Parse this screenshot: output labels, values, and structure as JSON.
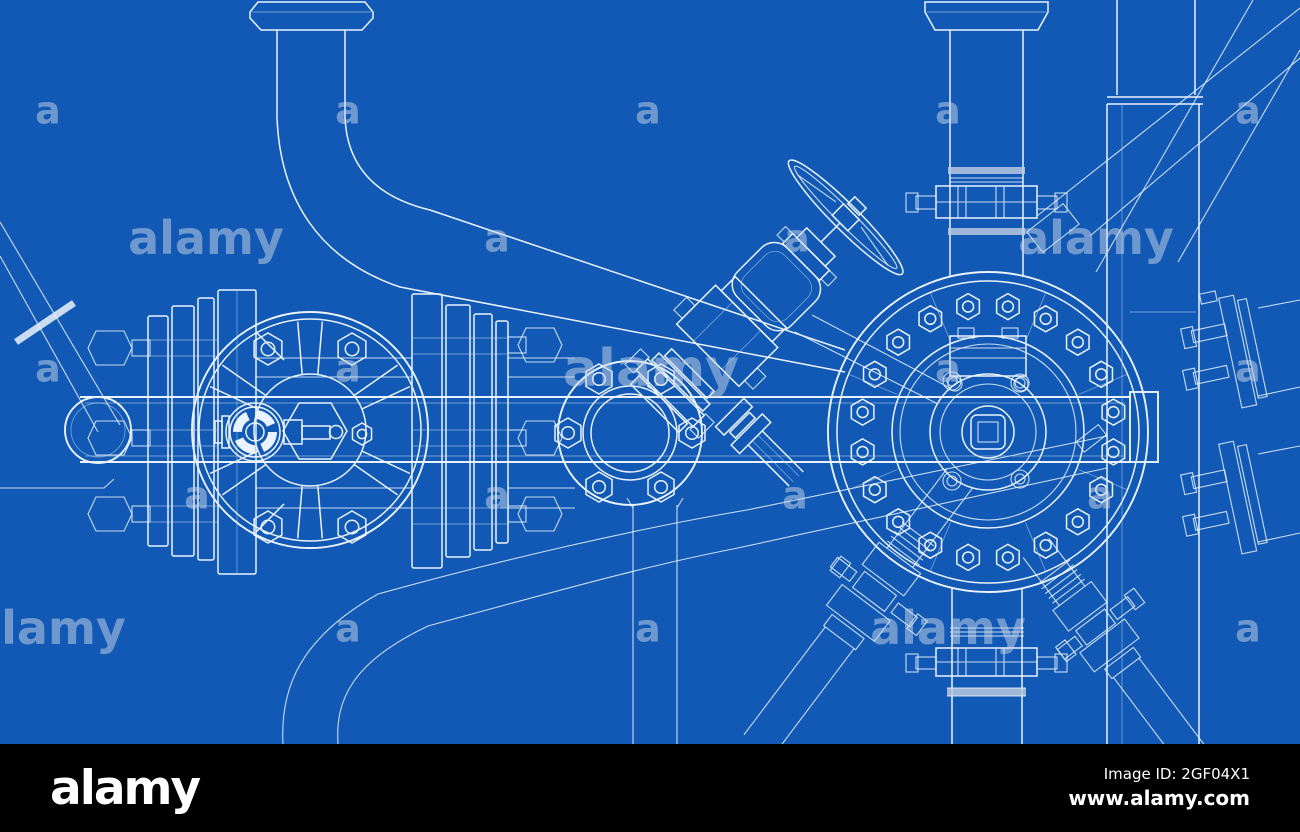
{
  "image": {
    "kind": "blueprint wireframe drawing",
    "subject": "industrial pipes, flanges and valves sketch on blue background",
    "width": 1300,
    "height": 832
  },
  "colors": {
    "background": "#1159b4",
    "line": "#eaf3fd",
    "faint_line": "#bcd6f0",
    "watermark": "#c6d4e6",
    "footer_bar": "#000000",
    "footer_text": "#ffffff",
    "band_fill": "#b9c9df"
  },
  "watermark": {
    "opacity": 0.52,
    "tile_items": [
      {
        "text": "a",
        "x": 48,
        "y": 110
      },
      {
        "text": "a",
        "x": 348,
        "y": 110
      },
      {
        "text": "a",
        "x": 648,
        "y": 110
      },
      {
        "text": "a",
        "x": 948,
        "y": 110
      },
      {
        "text": "a",
        "x": 1248,
        "y": 110
      },
      {
        "text": "alamy",
        "x": 206,
        "y": 238
      },
      {
        "text": "a",
        "x": 497,
        "y": 238
      },
      {
        "text": "a",
        "x": 797,
        "y": 238
      },
      {
        "text": "alamy",
        "x": 1096,
        "y": 238
      },
      {
        "text": "a",
        "x": 48,
        "y": 368
      },
      {
        "text": "a",
        "x": 348,
        "y": 368
      },
      {
        "text": "alamy",
        "x": 651,
        "y": 368,
        "big": true
      },
      {
        "text": "a",
        "x": 948,
        "y": 368
      },
      {
        "text": "a",
        "x": 1248,
        "y": 368
      },
      {
        "text": "a",
        "x": 197,
        "y": 495
      },
      {
        "text": "a",
        "x": 497,
        "y": 495
      },
      {
        "text": "a",
        "x": 795,
        "y": 495
      },
      {
        "text": "a",
        "x": 1100,
        "y": 495
      },
      {
        "text": "alamy",
        "x": 48,
        "y": 628
      },
      {
        "text": "a",
        "x": 348,
        "y": 628
      },
      {
        "text": "a",
        "x": 648,
        "y": 628
      },
      {
        "text": "alamy",
        "x": 948,
        "y": 628
      },
      {
        "text": "a",
        "x": 1248,
        "y": 628
      }
    ]
  },
  "footer": {
    "logo": "alamy",
    "image_id": "Image ID: 2GF04X1",
    "url": "www.alamy.com"
  }
}
